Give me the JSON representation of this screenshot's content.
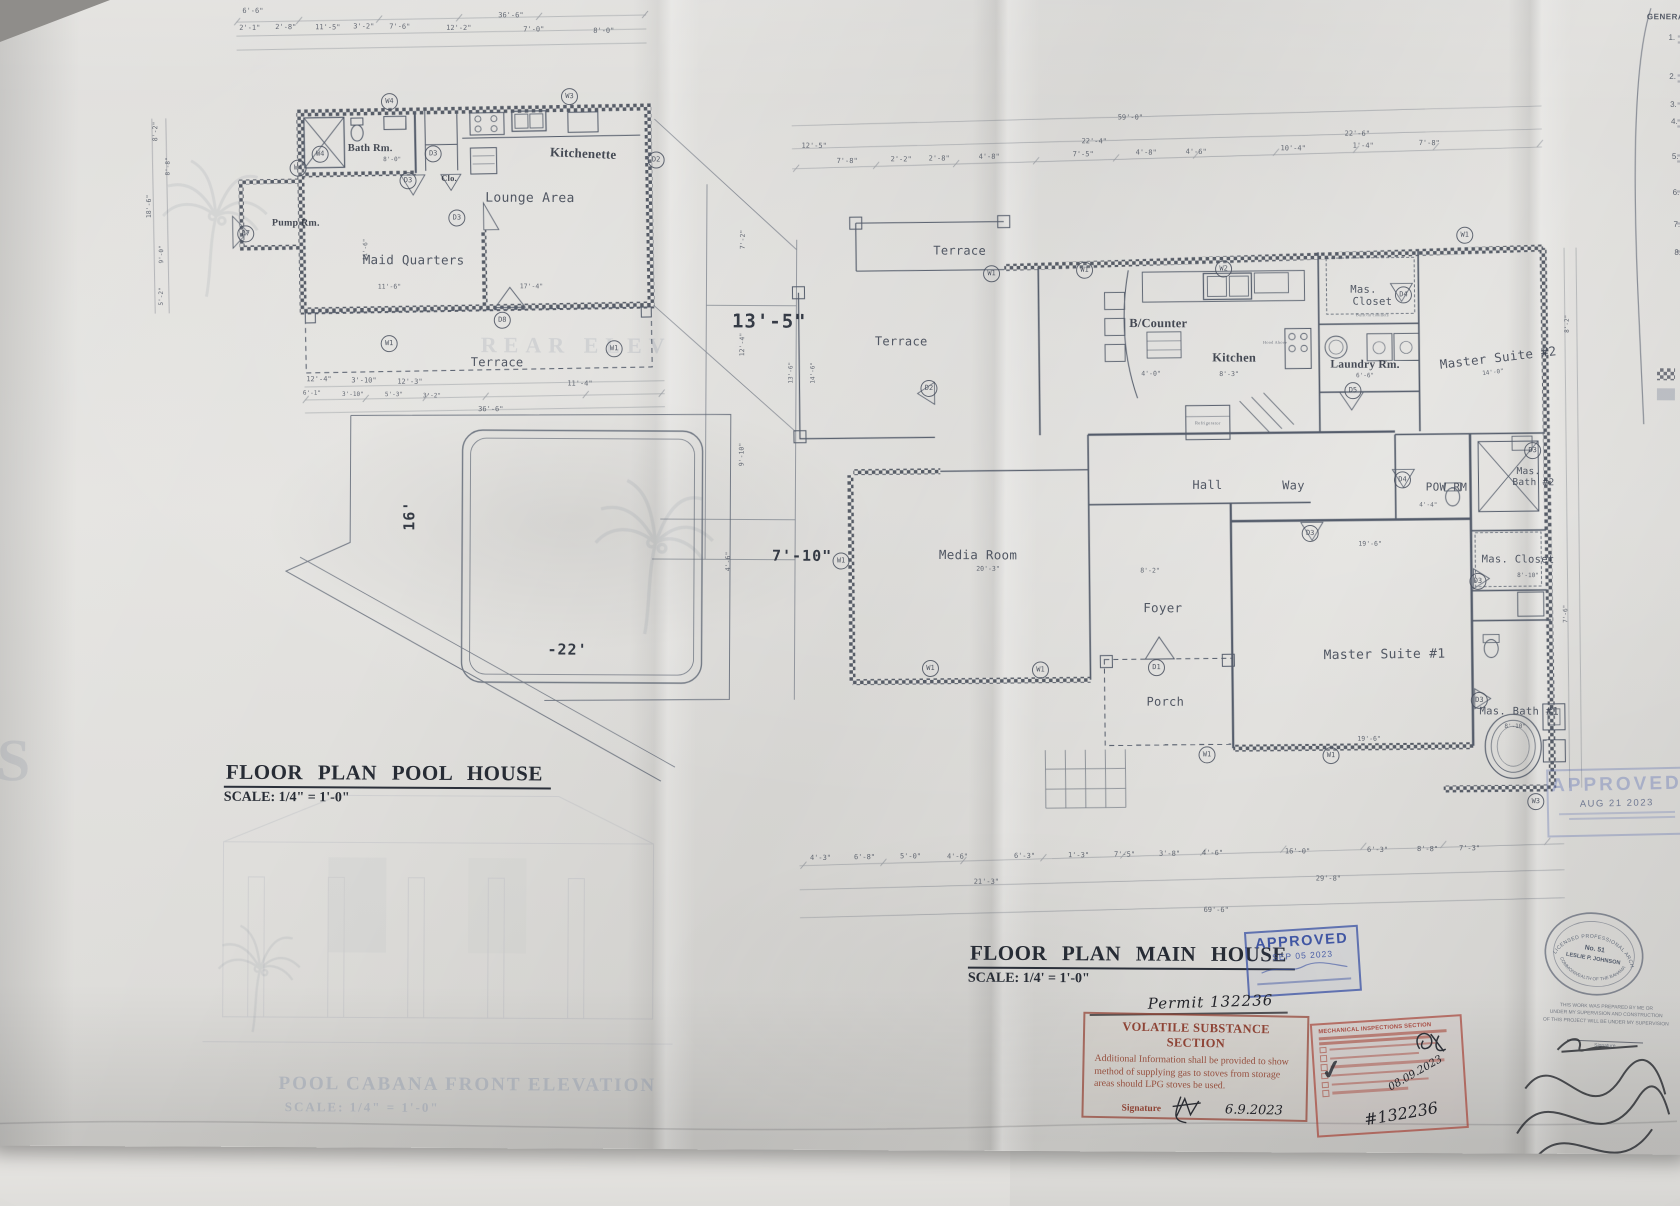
{
  "titles": {
    "pool": {
      "title": "FLOOR  PLAN POOL  HOUSE",
      "scale": "SCALE: 1/4\" = 1'-0\""
    },
    "main": {
      "title": "FLOOR PLAN  MAIN  HOUSE",
      "scale": "SCALE: 1/4' = 1'-0\""
    }
  },
  "colors": {
    "line": "#475060",
    "stamp_blue": "#3a52a4",
    "stamp_red": "#9c4434"
  },
  "rooms": [
    {
      "t": "Bath Rm.",
      "x": 368,
      "y": 151,
      "s": 10.5,
      "c": "s"
    },
    {
      "t": "Kitchenette",
      "x": 581,
      "y": 155,
      "s": 13,
      "c": "s",
      "r": 2
    },
    {
      "t": "Lounge Area",
      "x": 528,
      "y": 200,
      "s": 13
    },
    {
      "t": "Maid Quarters",
      "x": 412,
      "y": 262,
      "s": 12.5
    },
    {
      "t": "Pump Rm.",
      "x": 294,
      "y": 226,
      "s": 10,
      "c": "s"
    },
    {
      "t": "Clo.",
      "x": 447,
      "y": 180,
      "s": 8.5,
      "c": "s"
    },
    {
      "t": "Terrace",
      "x": 496,
      "y": 364,
      "s": 12
    },
    {
      "t": "Terrace",
      "x": 958,
      "y": 250,
      "s": 12
    },
    {
      "t": "Terrace",
      "x": 900,
      "y": 341,
      "s": 12
    },
    {
      "t": "Media Room",
      "x": 978,
      "y": 554,
      "s": 12.5
    },
    {
      "t": "B/Counter",
      "x": 1157,
      "y": 322,
      "s": 12.5,
      "c": "s"
    },
    {
      "t": "Kitchen",
      "x": 1233,
      "y": 356,
      "s": 12.5,
      "c": "s"
    },
    {
      "t": "Laundry Rm.",
      "x": 1364,
      "y": 362,
      "s": 11.5,
      "c": "s"
    },
    {
      "t": "Mas.",
      "x": 1362,
      "y": 287,
      "s": 10.5
    },
    {
      "t": "Closet",
      "x": 1371,
      "y": 299,
      "s": 10.5
    },
    {
      "t": "Master Suite #2",
      "x": 1497,
      "y": 354,
      "s": 12.5,
      "r": -7
    },
    {
      "t": "Hall",
      "x": 1207,
      "y": 483,
      "s": 12
    },
    {
      "t": "Way",
      "x": 1293,
      "y": 483,
      "s": 12
    },
    {
      "t": "POW RM",
      "x": 1446,
      "y": 484,
      "s": 11
    },
    {
      "t": "Mas.",
      "x": 1528,
      "y": 468,
      "s": 9.5
    },
    {
      "t": "Bath #2",
      "x": 1533,
      "y": 479,
      "s": 9.5
    },
    {
      "t": "Mas. Closet",
      "x": 1518,
      "y": 556,
      "s": 10.5
    },
    {
      "t": "Master Suite #1",
      "x": 1385,
      "y": 652,
      "s": 13,
      "r": -1
    },
    {
      "t": "Foyer",
      "x": 1163,
      "y": 606,
      "s": 12.5
    },
    {
      "t": "Porch",
      "x": 1166,
      "y": 700,
      "s": 12
    },
    {
      "t": "Mas. Bath #1",
      "x": 1520,
      "y": 708,
      "s": 10.5
    },
    {
      "t": "Refrigerator",
      "x": 1207,
      "y": 421,
      "s": 4.5,
      "c": "t"
    },
    {
      "t": "Hood Above",
      "x": 1274,
      "y": 340,
      "s": 4.2,
      "c": "t"
    },
    {
      "t": "Built-in cabinets",
      "x": 1371,
      "y": 312,
      "s": 4.2,
      "c": "t"
    }
  ],
  "ghosts": [
    {
      "t": "REAR ELEV",
      "x": 575,
      "y": 347,
      "s": 22,
      "c": "g"
    },
    {
      "t": "POOL CABANA FRONT ELEVATION",
      "x": 470,
      "y": 1087,
      "s": 19,
      "c": "g2"
    },
    {
      "t": "SCALE: 1/4\" = 1'-0\"",
      "x": 365,
      "y": 1110,
      "s": 13,
      "c": "g2"
    },
    {
      "t": "S",
      "x": 18,
      "y": 765,
      "s": 60,
      "c": "g"
    }
  ],
  "tags": [
    {
      "t": "W4",
      "x": 387,
      "y": 104
    },
    {
      "t": "W3",
      "x": 567,
      "y": 98
    },
    {
      "t": "W4",
      "x": 318,
      "y": 157
    },
    {
      "t": "W4",
      "x": 296,
      "y": 171
    },
    {
      "t": "D3",
      "x": 431,
      "y": 156
    },
    {
      "t": "D3",
      "x": 406,
      "y": 183
    },
    {
      "t": "D3",
      "x": 455,
      "y": 220
    },
    {
      "t": "D2",
      "x": 654,
      "y": 161
    },
    {
      "t": "D7",
      "x": 244,
      "y": 237
    },
    {
      "t": "D8",
      "x": 501,
      "y": 322
    },
    {
      "t": "W1",
      "x": 388,
      "y": 346
    },
    {
      "t": "W1",
      "x": 613,
      "y": 350
    },
    {
      "t": "W1",
      "x": 990,
      "y": 273
    },
    {
      "t": "W1",
      "x": 1083,
      "y": 269
    },
    {
      "t": "W2",
      "x": 1222,
      "y": 267
    },
    {
      "t": "W1",
      "x": 1463,
      "y": 232
    },
    {
      "t": "D4",
      "x": 1402,
      "y": 292
    },
    {
      "t": "D5",
      "x": 1352,
      "y": 388
    },
    {
      "t": "D2",
      "x": 928,
      "y": 388
    },
    {
      "t": "W1",
      "x": 841,
      "y": 561
    },
    {
      "t": "D4",
      "x": 1402,
      "y": 477
    },
    {
      "t": "D3",
      "x": 1532,
      "y": 447
    },
    {
      "t": "D3",
      "x": 1310,
      "y": 531
    },
    {
      "t": "D3",
      "x": 1478,
      "y": 578
    },
    {
      "t": "D3",
      "x": 1480,
      "y": 697
    },
    {
      "t": "D1",
      "x": 1157,
      "y": 666
    },
    {
      "t": "W1",
      "x": 931,
      "y": 668
    },
    {
      "t": "W1",
      "x": 1041,
      "y": 669
    },
    {
      "t": "W1",
      "x": 1208,
      "y": 753
    },
    {
      "t": "W1",
      "x": 1332,
      "y": 753
    },
    {
      "t": "W3",
      "x": 1537,
      "y": 798
    }
  ],
  "dims": [
    {
      "t": "6'-6\"",
      "x": 250,
      "y": 14
    },
    {
      "t": "36'-6\"",
      "x": 508,
      "y": 17
    },
    {
      "t": "2'-1\"",
      "x": 247,
      "y": 31
    },
    {
      "t": "2'-8\"",
      "x": 283,
      "y": 30
    },
    {
      "t": "11'-5\"",
      "x": 325,
      "y": 30
    },
    {
      "t": "3'-2\"",
      "x": 361,
      "y": 29
    },
    {
      "t": "7'-6\"",
      "x": 397,
      "y": 29
    },
    {
      "t": "12'-2\"",
      "x": 456,
      "y": 30
    },
    {
      "t": "7'-0\"",
      "x": 531,
      "y": 31
    },
    {
      "t": "8'-0\"",
      "x": 601,
      "y": 32
    },
    {
      "t": "8'-2\"",
      "x": 153,
      "y": 135,
      "r": -90,
      "s": 6.5
    },
    {
      "t": "18'-6\"",
      "x": 147,
      "y": 210,
      "r": -90,
      "s": 6.5
    },
    {
      "t": "8'-8\"",
      "x": 166,
      "y": 170,
      "r": -90,
      "s": 6
    },
    {
      "t": "9'-0\"",
      "x": 160,
      "y": 258,
      "r": -90,
      "s": 6
    },
    {
      "t": "5'-2\"",
      "x": 160,
      "y": 300,
      "r": -90,
      "s": 6
    },
    {
      "t": "8'-0\"",
      "x": 390,
      "y": 162,
      "s": 6
    },
    {
      "t": "11'-6\"",
      "x": 364,
      "y": 252,
      "r": -90,
      "s": 6
    },
    {
      "t": "11'-6\"",
      "x": 388,
      "y": 289,
      "s": 6.5
    },
    {
      "t": "17'-4\"",
      "x": 530,
      "y": 288,
      "s": 6.5
    },
    {
      "t": "12'-4\"",
      "x": 318,
      "y": 382
    },
    {
      "t": "3'-10\"",
      "x": 363,
      "y": 383
    },
    {
      "t": "12'-3\"",
      "x": 409,
      "y": 384
    },
    {
      "t": "11'-4\"",
      "x": 579,
      "y": 385
    },
    {
      "t": "6'-1\"",
      "x": 311,
      "y": 396,
      "s": 6
    },
    {
      "t": "3'-10\"",
      "x": 352,
      "y": 397,
      "s": 6
    },
    {
      "t": "5'-3\"",
      "x": 393,
      "y": 397,
      "s": 6
    },
    {
      "t": "3'-2\"",
      "x": 431,
      "y": 398,
      "s": 6
    },
    {
      "t": "36'-6\"",
      "x": 490,
      "y": 411
    },
    {
      "t": "13'-5\"",
      "x": 768,
      "y": 322,
      "s": 19,
      "c": "b"
    },
    {
      "t": "7'-10\"",
      "x": 802,
      "y": 556,
      "s": 15,
      "c": "b"
    },
    {
      "t": "12'-4\"",
      "x": 741,
      "y": 345,
      "r": -90,
      "s": 6.5
    },
    {
      "t": "7'-2\"",
      "x": 741,
      "y": 240,
      "r": -90,
      "s": 6.5
    },
    {
      "t": "9'-10\"",
      "x": 741,
      "y": 455,
      "r": -90,
      "s": 6.5
    },
    {
      "t": "4'-6\"",
      "x": 728,
      "y": 562,
      "r": -90,
      "s": 6.5
    },
    {
      "t": "13'-6\"",
      "x": 790,
      "y": 373,
      "r": -90,
      "s": 6
    },
    {
      "t": "14'-6\"",
      "x": 812,
      "y": 373,
      "r": -90,
      "s": 6
    },
    {
      "t": "16'",
      "x": 409,
      "y": 518,
      "r": -90,
      "s": 15,
      "c": "b"
    },
    {
      "t": "-22'",
      "x": 568,
      "y": 651,
      "s": 15,
      "c": "b"
    },
    {
      "t": "59'-0\"",
      "x": 1128,
      "y": 116
    },
    {
      "t": "12'-5\"",
      "x": 812,
      "y": 146
    },
    {
      "t": "22'-4\"",
      "x": 1092,
      "y": 140
    },
    {
      "t": "22'-6\"",
      "x": 1355,
      "y": 131
    },
    {
      "t": "7'-8\"",
      "x": 845,
      "y": 161
    },
    {
      "t": "2'-2\"",
      "x": 899,
      "y": 159
    },
    {
      "t": "2'-8\"",
      "x": 937,
      "y": 158
    },
    {
      "t": "4'-8\"",
      "x": 987,
      "y": 156
    },
    {
      "t": "7'-5\"",
      "x": 1081,
      "y": 153
    },
    {
      "t": "4'-8\"",
      "x": 1144,
      "y": 151
    },
    {
      "t": "4'-6\"",
      "x": 1194,
      "y": 150
    },
    {
      "t": "10'-4\"",
      "x": 1291,
      "y": 146
    },
    {
      "t": "1'-4\"",
      "x": 1361,
      "y": 143
    },
    {
      "t": "7'-8\"",
      "x": 1427,
      "y": 140
    },
    {
      "t": "20'-3\"",
      "x": 988,
      "y": 568,
      "s": 6.5
    },
    {
      "t": "8'-2\"",
      "x": 1150,
      "y": 569,
      "s": 6.5
    },
    {
      "t": "4'-0\"",
      "x": 1150,
      "y": 372,
      "s": 6.5
    },
    {
      "t": "8'-3\"",
      "x": 1228,
      "y": 372,
      "s": 6.5
    },
    {
      "t": "6'-6\"",
      "x": 1364,
      "y": 373,
      "s": 6
    },
    {
      "t": "14'-0\"",
      "x": 1492,
      "y": 369,
      "r": -7,
      "s": 6
    },
    {
      "t": "19'-6\"",
      "x": 1370,
      "y": 541,
      "s": 6.5
    },
    {
      "t": "19'-6\"",
      "x": 1370,
      "y": 736,
      "s": 6.5
    },
    {
      "t": "8'-10\"",
      "x": 1528,
      "y": 572,
      "s": 6
    },
    {
      "t": "8'-10\"",
      "x": 1516,
      "y": 723,
      "s": 6
    },
    {
      "t": "4'-4\"",
      "x": 1428,
      "y": 502,
      "s": 6
    },
    {
      "t": "4'-3\"",
      "x": 822,
      "y": 858
    },
    {
      "t": "6'-8\"",
      "x": 866,
      "y": 857
    },
    {
      "t": "5'-0\"",
      "x": 912,
      "y": 856
    },
    {
      "t": "4'-6\"",
      "x": 959,
      "y": 856
    },
    {
      "t": "6'-3\"",
      "x": 1026,
      "y": 855
    },
    {
      "t": "1'-3\"",
      "x": 1080,
      "y": 854
    },
    {
      "t": "7'-5\"",
      "x": 1126,
      "y": 853
    },
    {
      "t": "3'-8\"",
      "x": 1171,
      "y": 852
    },
    {
      "t": "4'-6\"",
      "x": 1214,
      "y": 851
    },
    {
      "t": "16'-0\"",
      "x": 1299,
      "y": 849
    },
    {
      "t": "6'-3\"",
      "x": 1379,
      "y": 847
    },
    {
      "t": "8'-8\"",
      "x": 1429,
      "y": 846
    },
    {
      "t": "7'-3\"",
      "x": 1471,
      "y": 845
    },
    {
      "t": "21'-3\"",
      "x": 988,
      "y": 881
    },
    {
      "t": "29'-8\"",
      "x": 1330,
      "y": 876
    },
    {
      "t": "69'-6\"",
      "x": 1218,
      "y": 908
    },
    {
      "t": "8'-2\"",
      "x": 1566,
      "y": 320,
      "r": -90,
      "s": 6
    },
    {
      "t": "7'-6\"",
      "x": 1566,
      "y": 610,
      "r": -90,
      "s": 6
    }
  ],
  "notes": {
    "title": "GENERAL",
    "items": [
      {
        "t": "1.",
        "x": 1669,
        "y": 33
      },
      {
        "t": "2.",
        "x": 1670,
        "y": 72
      },
      {
        "t": "3.",
        "x": 1671,
        "y": 100
      },
      {
        "t": "4.",
        "x": 1672,
        "y": 117
      },
      {
        "t": "5.",
        "x": 1673,
        "y": 152
      },
      {
        "t": "6.",
        "x": 1674,
        "y": 188
      },
      {
        "t": "7.",
        "x": 1675,
        "y": 220
      },
      {
        "t": "8.",
        "x": 1676,
        "y": 248
      }
    ]
  },
  "stamps": {
    "approved_sep": {
      "word": "APPROVED",
      "date": "SEP 05 2023"
    },
    "approved_aug": {
      "word": "APPROVED",
      "date": "AUG 21 2023"
    },
    "permit": "Permit 132236",
    "volatile": {
      "title": "VOLATILE SUBSTANCE SECTION",
      "body": "Additional Information shall be provided to show method of supplying gas to stoves from storage areas should LPG stoves be used.",
      "signature_label": "Signature",
      "date": "6.9.2023"
    },
    "mechanical": {
      "title": "MECHANICAL INSPECTIONS SECTION",
      "date": "08.09.2023",
      "number": "#132236",
      "check": "✓"
    },
    "seal": {
      "arc_top": "LICENSED PROFESSIONAL ARCHITECT",
      "no": "No. 51",
      "name": "LESLIE P. JOHNSON",
      "arc_bottom": "COMMONWEALTH OF THE BAHAMAS"
    },
    "prepared": {
      "line1": "THIS WORK WAS PREPARED BY ME OR",
      "line2": "UNDER MY SUPERVISION AND CONSTRUCTION",
      "line3": "OF THIS PROJECT WILL BE UNDER MY SUPERVISION",
      "signature_label": "Signature"
    }
  }
}
